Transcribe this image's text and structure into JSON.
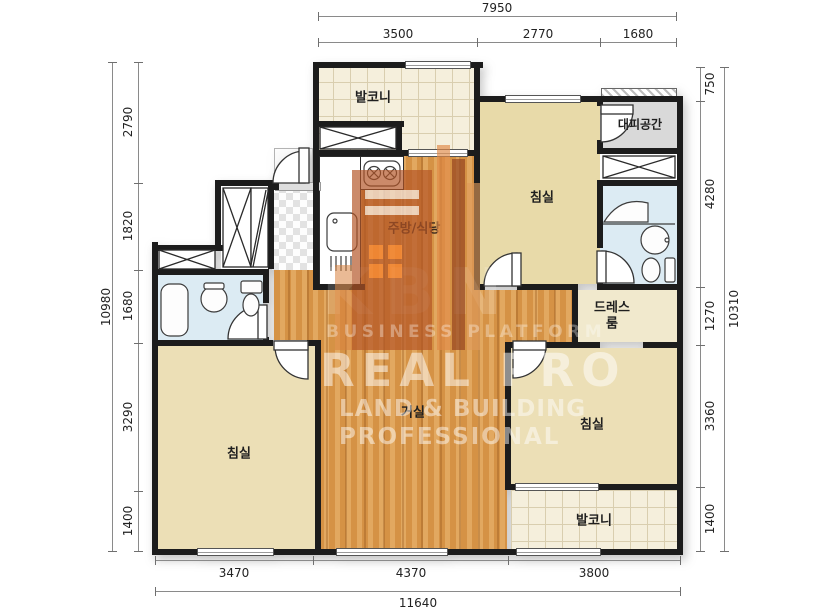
{
  "meta": {
    "type": "apartment-floor-plan"
  },
  "dimensions": {
    "top": {
      "total": "7950",
      "segments": [
        "3500",
        "2770",
        "1680"
      ]
    },
    "bottom": {
      "total": "11640",
      "segments": [
        "3470",
        "4370",
        "3800"
      ]
    },
    "left": {
      "total": "10980",
      "segments": [
        "2790",
        "1820",
        "1680",
        "3290",
        "1400"
      ]
    },
    "right": {
      "total": "10310",
      "segments": [
        "750",
        "4280",
        "1270",
        "3360",
        "1400"
      ]
    }
  },
  "rooms": {
    "balcony_top": {
      "label": "발코니"
    },
    "bedroom_top_right": {
      "label": "침실"
    },
    "evacuation": {
      "label": "대피공간"
    },
    "kitchen": {
      "label": "주방/식당"
    },
    "dressroom": {
      "label": "드레스룸"
    },
    "living": {
      "label": "거실"
    },
    "bedroom_left": {
      "label": "침실"
    },
    "bedroom_right": {
      "label": "침실"
    },
    "balcony_bottom": {
      "label": "발코니"
    }
  },
  "watermark": {
    "letters": "KBN",
    "tagline_top": "BUSINESS PLATFORM",
    "brand": "REAL PRO",
    "tagline_mid": "LAND & BUILDING",
    "tagline_bottom": "PROFESSIONAL"
  },
  "colors": {
    "wall": "#1c1c1c",
    "wood_floor": "#d59245",
    "room_tan": "#e8daa9",
    "balcony_tile": "#f5efdc",
    "bath_blue": "#dcebf3",
    "evac_gray": "#d9d9d9",
    "wm_orange": "#b35426"
  }
}
